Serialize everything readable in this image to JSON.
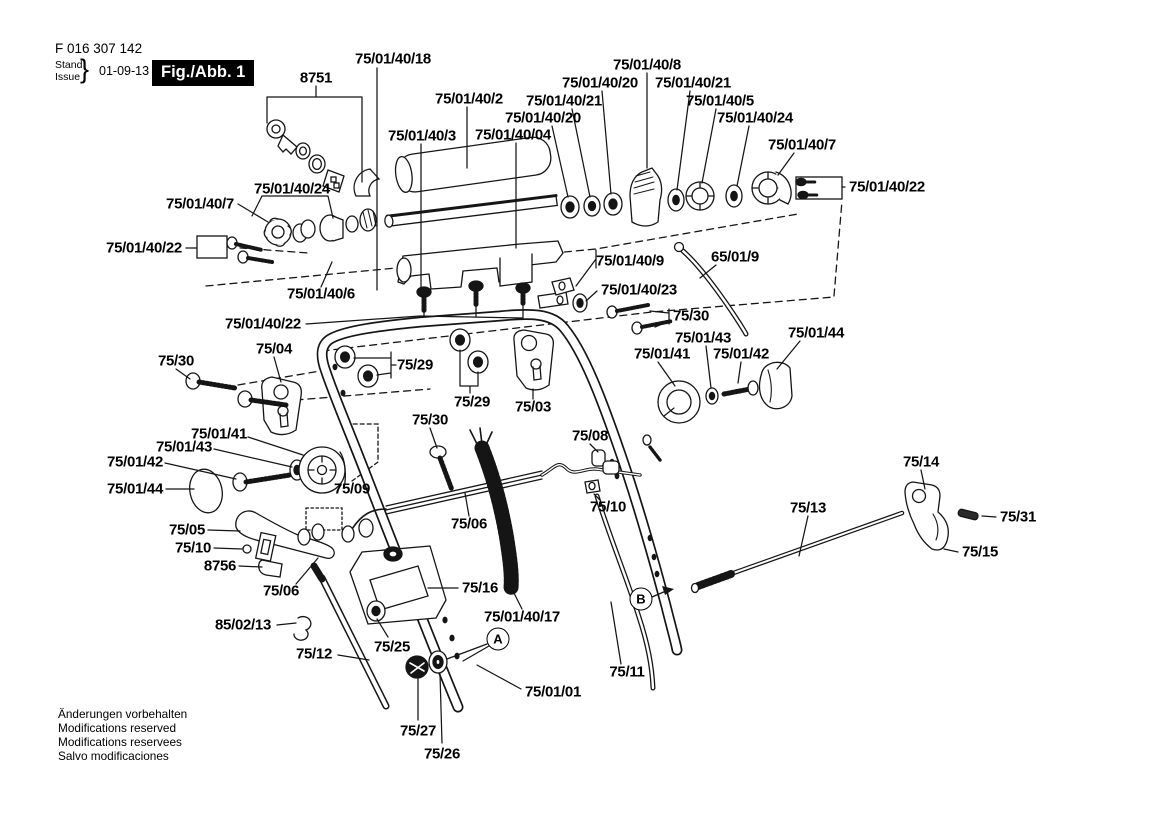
{
  "header": {
    "part_number": "F 016 307 142",
    "stand_label": "Stand",
    "issue_label": "Issue",
    "brace": "}",
    "date": "01-09-13",
    "figure_badge": "Fig./Abb. 1"
  },
  "footer": {
    "lines": [
      "Änderungen vorbehalten",
      "Modifications reserved",
      "Modifications reservees",
      "Salvo modificaciones"
    ]
  },
  "diagram": {
    "labels": [
      {
        "text": "75/01/40/18",
        "x": 393,
        "y": 59
      },
      {
        "text": "8751",
        "x": 316,
        "y": 78
      },
      {
        "text": "75/01/40/2",
        "x": 469,
        "y": 99
      },
      {
        "text": "75/01/40/8",
        "x": 647,
        "y": 65
      },
      {
        "text": "75/01/40/20",
        "x": 600,
        "y": 83
      },
      {
        "text": "75/01/40/21",
        "x": 693,
        "y": 83
      },
      {
        "text": "75/01/40/21",
        "x": 564,
        "y": 101
      },
      {
        "text": "75/01/40/5",
        "x": 720,
        "y": 101
      },
      {
        "text": "75/01/40/20",
        "x": 543,
        "y": 118
      },
      {
        "text": "75/01/40/24",
        "x": 755,
        "y": 118
      },
      {
        "text": "75/01/40/3",
        "x": 422,
        "y": 136
      },
      {
        "text": "75/01/40/04",
        "x": 513,
        "y": 135
      },
      {
        "text": "75/01/40/7",
        "x": 802,
        "y": 145
      },
      {
        "text": "75/01/40/22",
        "x": 887,
        "y": 187
      },
      {
        "text": "75/01/40/24",
        "x": 292,
        "y": 189
      },
      {
        "text": "75/01/40/7",
        "x": 200,
        "y": 204
      },
      {
        "text": "75/01/40/22",
        "x": 144,
        "y": 248
      },
      {
        "text": "65/01/9",
        "x": 735,
        "y": 257
      },
      {
        "text": "75/01/40/9",
        "x": 630,
        "y": 261
      },
      {
        "text": "75/01/40/23",
        "x": 639,
        "y": 290
      },
      {
        "text": "75/01/40/6",
        "x": 321,
        "y": 294
      },
      {
        "text": "75/30",
        "x": 691,
        "y": 316
      },
      {
        "text": "75/01/40/22",
        "x": 263,
        "y": 324
      },
      {
        "text": "75/01/44",
        "x": 816,
        "y": 333
      },
      {
        "text": "75/01/43",
        "x": 703,
        "y": 338
      },
      {
        "text": "75/04",
        "x": 274,
        "y": 349
      },
      {
        "text": "75/01/41",
        "x": 662,
        "y": 354
      },
      {
        "text": "75/01/42",
        "x": 741,
        "y": 354
      },
      {
        "text": "75/30",
        "x": 176,
        "y": 361
      },
      {
        "text": "75/29",
        "x": 415,
        "y": 365
      },
      {
        "text": "75/29",
        "x": 472,
        "y": 402
      },
      {
        "text": "75/03",
        "x": 533,
        "y": 407
      },
      {
        "text": "75/30",
        "x": 430,
        "y": 420
      },
      {
        "text": "75/01/41",
        "x": 219,
        "y": 434
      },
      {
        "text": "75/08",
        "x": 590,
        "y": 436
      },
      {
        "text": "75/01/43",
        "x": 184,
        "y": 447
      },
      {
        "text": "75/01/42",
        "x": 135,
        "y": 462
      },
      {
        "text": "75/14",
        "x": 921,
        "y": 462
      },
      {
        "text": "75/01/44",
        "x": 135,
        "y": 489
      },
      {
        "text": "75/09",
        "x": 352,
        "y": 489
      },
      {
        "text": "75/10",
        "x": 608,
        "y": 507
      },
      {
        "text": "75/13",
        "x": 808,
        "y": 508
      },
      {
        "text": "75/31",
        "x": 1018,
        "y": 517
      },
      {
        "text": "75/06",
        "x": 469,
        "y": 524
      },
      {
        "text": "75/05",
        "x": 187,
        "y": 530
      },
      {
        "text": "75/10",
        "x": 193,
        "y": 548
      },
      {
        "text": "75/15",
        "x": 980,
        "y": 552
      },
      {
        "text": "8756",
        "x": 220,
        "y": 566
      },
      {
        "text": "75/16",
        "x": 480,
        "y": 588
      },
      {
        "text": "75/06",
        "x": 281,
        "y": 591
      },
      {
        "text": "75/01/40/17",
        "x": 522,
        "y": 617
      },
      {
        "text": "85/02/13",
        "x": 243,
        "y": 625
      },
      {
        "text": "75/25",
        "x": 392,
        "y": 647
      },
      {
        "text": "75/12",
        "x": 314,
        "y": 654
      },
      {
        "text": "75/11",
        "x": 627,
        "y": 672
      },
      {
        "text": "75/01/01",
        "x": 553,
        "y": 692
      },
      {
        "text": "75/27",
        "x": 418,
        "y": 731
      },
      {
        "text": "75/26",
        "x": 442,
        "y": 754
      }
    ],
    "markers": [
      {
        "text": "A",
        "x": 498,
        "y": 639
      },
      {
        "text": "B",
        "x": 641,
        "y": 599
      }
    ]
  }
}
